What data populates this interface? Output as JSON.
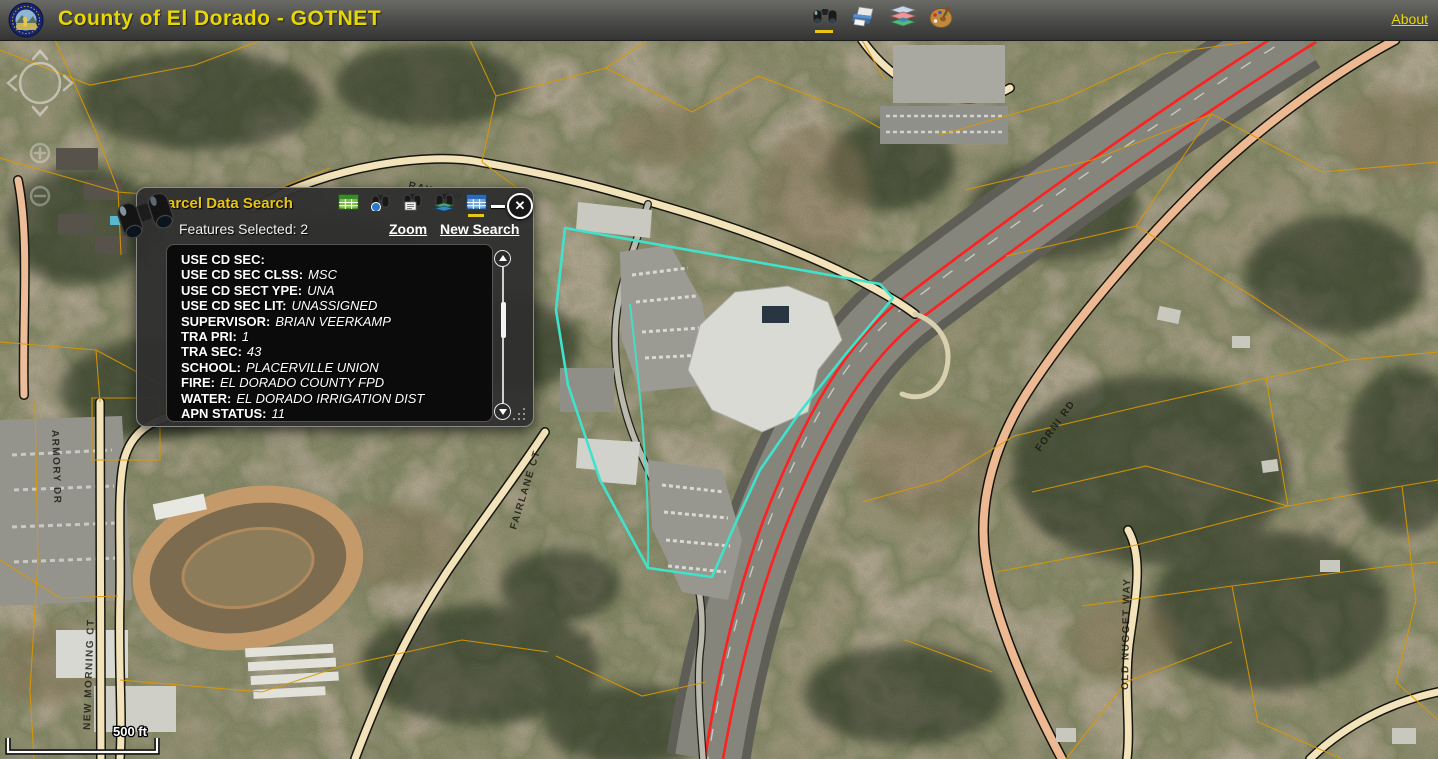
{
  "header": {
    "title": "County of El Dorado - GOTNET",
    "about_label": "About"
  },
  "panel": {
    "title": "Parcel Data Search",
    "features_selected": "Features Selected: 2",
    "links": {
      "zoom": "Zoom",
      "new_search": "New Search"
    },
    "fields": [
      {
        "label": "USE CD SEC:",
        "value": ""
      },
      {
        "label": "USE CD SEC CLSS:",
        "value": "MSC"
      },
      {
        "label": "USE CD SECT YPE:",
        "value": "UNA"
      },
      {
        "label": "USE CD SEC LIT:",
        "value": "UNASSIGNED"
      },
      {
        "label": "SUPERVISOR:",
        "value": "BRIAN VEERKAMP"
      },
      {
        "label": "TRA PRI:",
        "value": "1"
      },
      {
        "label": "TRA SEC:",
        "value": "43"
      },
      {
        "label": "SCHOOL:",
        "value": "PLACERVILLE UNION"
      },
      {
        "label": "FIRE:",
        "value": "EL DORADO COUNTY FPD"
      },
      {
        "label": "WATER:",
        "value": "EL DORADO IRRIGATION DIST"
      },
      {
        "label": "APN STATUS:",
        "value": "11"
      }
    ]
  },
  "map": {
    "scale_label": "500 ft",
    "streets": [
      "RAY LAWYER DR",
      "NEW MORNING CT",
      "ARMORY DR",
      "FORNI RD",
      "OLD NUGGET WAY",
      "FAIRLANE CT"
    ],
    "colors": {
      "parcel_line": "#DC9800",
      "selection_outline": "#3FE3CB",
      "highway_route": "#FF2020",
      "accent_yellow": "#E9C716"
    }
  }
}
